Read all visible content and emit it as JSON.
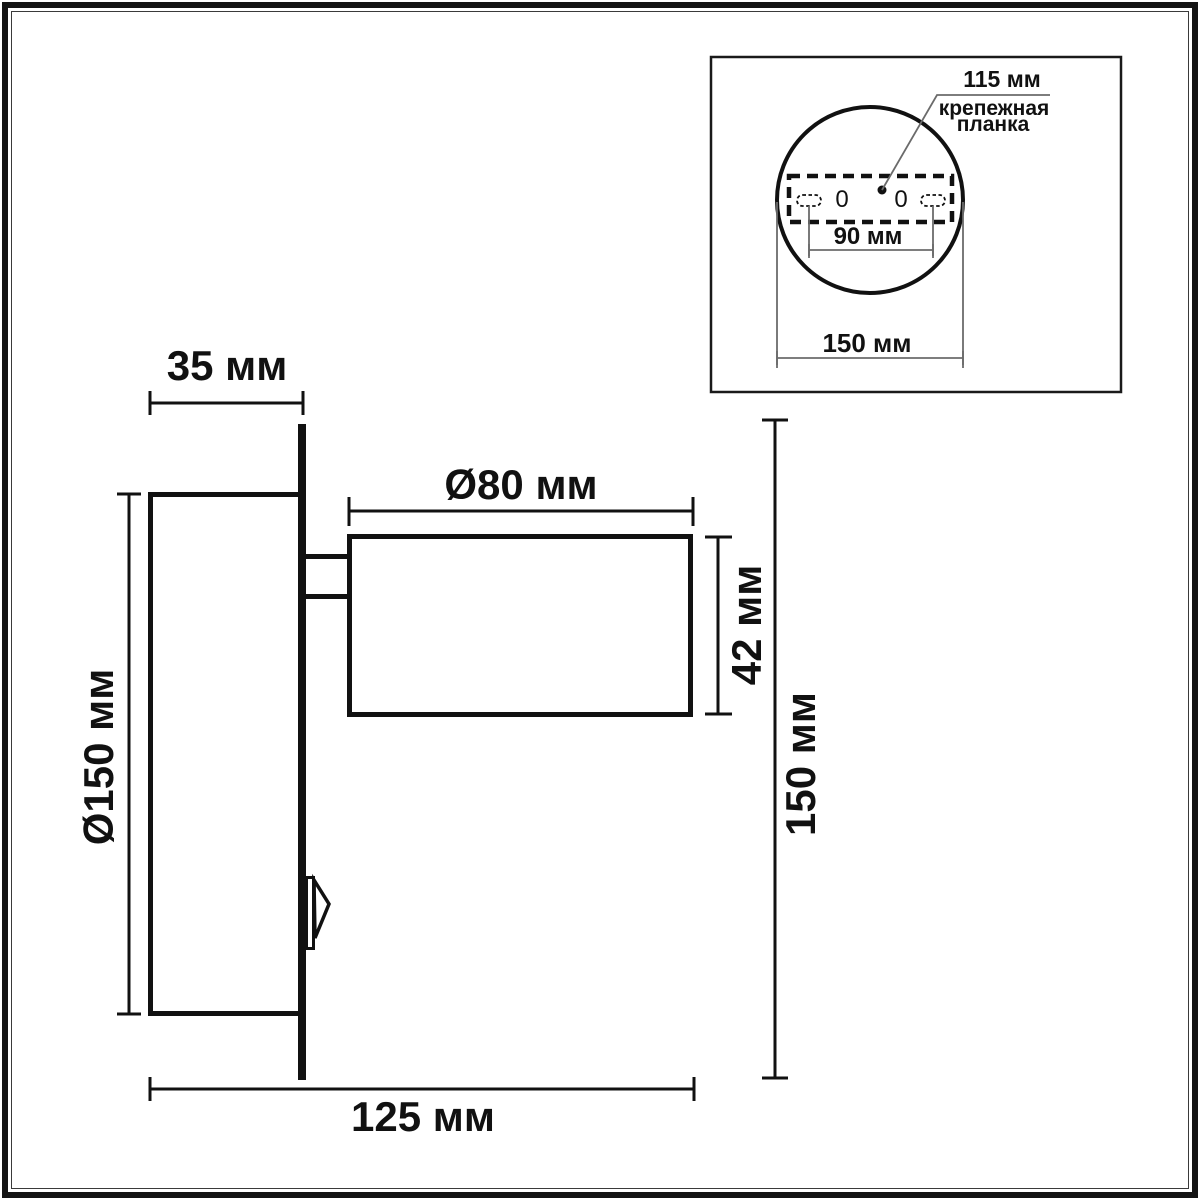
{
  "page": {
    "background": "#ffffff",
    "line_color": "#111111",
    "thin_line_color": "#6b6b6b"
  },
  "main_view": {
    "labels": {
      "backplate_depth": "35 мм",
      "backplate_diameter": "Ø150 мм",
      "head_diameter": "Ø80 мм",
      "head_height": "42 мм",
      "total_height": "150 мм",
      "total_width": "125 мм"
    }
  },
  "inset_view": {
    "labels": {
      "plate_length": "115 мм",
      "plate_name_line1": "крепежная",
      "plate_name_line2": "планка",
      "hole_spacing": "90 мм",
      "base_diameter": "150 мм",
      "hole_left": "0",
      "hole_right": "0"
    }
  }
}
